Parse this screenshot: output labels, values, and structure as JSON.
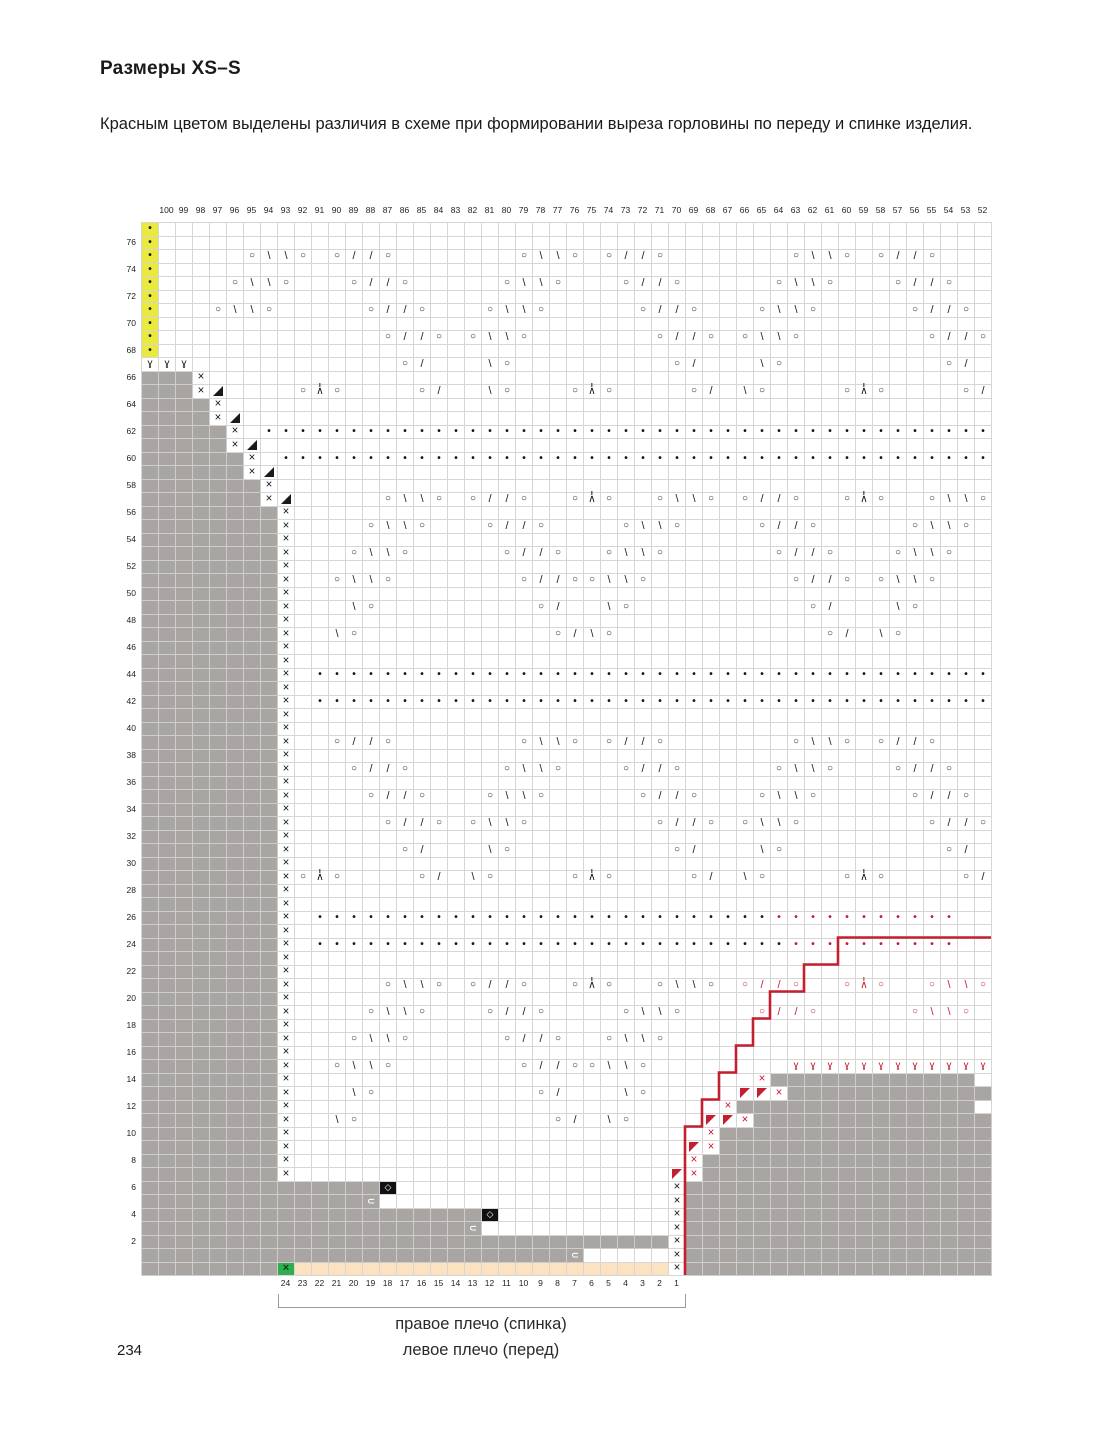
{
  "page": {
    "title": "Размеры XS–S",
    "description": "Красным цветом выделены различия в схеме при формировании выреза горловины по переду и спинке изделия.",
    "page_number": "234"
  },
  "chart_data": {
    "type": "knitting-chart",
    "title": "Схема вязания, размеры XS–S",
    "grid_size": {
      "columns": 50,
      "rows": 78
    },
    "columns_top": [
      100,
      99,
      98,
      97,
      96,
      95,
      94,
      93,
      92,
      91,
      90,
      89,
      88,
      87,
      86,
      85,
      84,
      83,
      82,
      81,
      80,
      79,
      78,
      77,
      76,
      75,
      74,
      73,
      72,
      71,
      70,
      69,
      68,
      67,
      66,
      65,
      64,
      63,
      62,
      61,
      60,
      59,
      58,
      57,
      56,
      55,
      54,
      53,
      52
    ],
    "rows_left": [
      76,
      74,
      72,
      70,
      68,
      66,
      64,
      62,
      60,
      58,
      56,
      54,
      52,
      50,
      48,
      46,
      44,
      42,
      40,
      38,
      36,
      34,
      32,
      30,
      28,
      26,
      24,
      22,
      20,
      18,
      16,
      14,
      12,
      10,
      8,
      6,
      4,
      2
    ],
    "columns_bottom": [
      24,
      23,
      22,
      21,
      20,
      19,
      18,
      17,
      16,
      15,
      14,
      13,
      12,
      11,
      10,
      9,
      8,
      7,
      6,
      5,
      4,
      3,
      2,
      1
    ],
    "bottom_numbers_start_column_index": 8,
    "colors": {
      "red": "#c41f30",
      "gray": "#a8a5a2",
      "yellow": "#e9e93e",
      "green": "#2fae4e",
      "beige": "#fbe3c2",
      "blackcell": "#111111",
      "gridline": "#d6d6d6"
    },
    "symbol_key": {
      ".": "empty",
      "g": "gray-no-stitch",
      "y": "yellow-edge-cell-purl-dot",
      "o": "yarn-over",
      "O": "yarn-over-red",
      "f": "left-slant-decrease",
      "F": "left-slant-decrease-red",
      "b": "right-slant-decrease",
      "B": "right-slant-decrease-red",
      "p": "purl-dot",
      "P": "purl-dot-red",
      "x": "cross-stitch",
      "X": "cross-stitch-red",
      "a": "central-double-decrease",
      "W": "central-double-decrease-red",
      "t": "bind-off-triangle-black",
      "T": "bind-off-triangle-red",
      "v": "twisted-stitch",
      "V": "twisted-stitch-red",
      "d": "black-cell-white-diamond",
      "c": "gray-cell-white-bracket",
      "e": "green-cell-cross",
      "n": "beige-highlight-cell"
    },
    "grid": [
      "y.................................................",
      "y.................................................",
      "y.....obbo.offo.......obbo.offo.......obbo.offo...",
      "y.................................................",
      "y....obbo...offo.....obbo...offo.....obbo...offo..",
      "y.................................................",
      "y...obbo.....offo...obbo.....offo...obbo.....offo.",
      "y.................................................",
      "y.............offo.obbo.......offo.obbo.......offo",
      "y.................................................",
      "vvv............of...bo.........of...bo.........of.",
      "gggx..............................................",
      "gggxt....oao....of..bo...oao....of.bo....oao....of",
      "ggggx.............................................",
      "ggggxt............................................",
      "gggggx.ppppppppppppppppppppppppppppppppppppppppppp",
      "gggggxt...........................................",
      "ggggggx.pppppppppppppppppppppppppppppppppppppppppp",
      "ggggggxt..........................................",
      "gggggggx..........................................",
      "gggggggxt.....obbo.offo..oao..obbo.offo..oao..obbo",
      "ggggggggx.........................................",
      "ggggggggx....obbo...offo....obbo....offo.....obbo.",
      "ggggggggx.........................................",
      "ggggggggx...obbo.....offo..obbo......offo...obbo..",
      "ggggggggx.........................................",
      "ggggggggx..obbo.......offoobbo........offo.obbo...",
      "ggggggggx.........................................",
      "ggggggggx...bo.........of..bo..........of...bo....",
      "ggggggggx.........................................",
      "ggggggggx..bo...........ofbo............of.bo.....",
      "ggggggggx.........................................",
      "ggggggggx.........................................",
      "ggggggggx.pppppppppppppppppppppppppppppppppppppppp",
      "ggggggggx.........................................",
      "ggggggggx.pppppppppppppppppppppppppppppppppppppppp",
      "ggggggggx.........................................",
      "ggggggggx.........................................",
      "ggggggggx..offo.......obbo.offo.......obbo.offo...",
      "ggggggggx.........................................",
      "ggggggggx...offo.....obbo...offo.....obbo...offo..",
      "ggggggggx.........................................",
      "ggggggggx....offo...obbo.....offo...obbo.....offo.",
      "ggggggggx.........................................",
      "ggggggggx.....offo.obbo.......offo.obbo.......offo",
      "ggggggggx.........................................",
      "ggggggggx......of...bo.........of...bo.........of.",
      "ggggggggx.........................................",
      "ggggggggxoao....of.bo....oao....of.bo....oao....of",
      "ggggggggx.........................................",
      "ggggggggx.........................................",
      "ggggggggx.pppppppppppppppppppppppppppPPPPPPPPPPP",
      "ggggggggx.........................................",
      "ggggggggx.ppppppppppppppppppppppppppppPPPPPPPPPP",
      "ggggggggx.........................................",
      "ggggggggx.........................................",
      "ggggggggx.....obbo.offo..oao..obbo.OFFO..OWO..OBBO",
      "ggggggggx.........................................",
      "ggggggggx....obbo...offo....obbo....OFFO.....OBBO.",
      "ggggggggx.........................................",
      "ggggggggx...obbo.....offo..obbo...................",
      "ggggggggx.........................................",
      "ggggggggx..obbo.......offoobbo........VVVVVVVVVVVV",
      "ggggggggx...........................Xgggggggggggg",
      "ggggggggx...bo.........of...bo.....TTXgggggggggggg",
      "ggggggggx.........................Xgggggggggggggg",
      "ggggggggx..bo...........of.bo....TTXgggggggggggggg",
      "ggggggggx........................Xgggggggggggggggg",
      "ggggggggx.......................TXgggggggggggggggg",
      "ggggggggx.......................Xggggggggggggggggg",
      "ggggggggx......................TXggggggggggggggggg",
      "ggggggggggggggd................xgggggggggggggggggg",
      "gggggggggggggc.................xgggggggggggggggggg",
      "ggggggggggggggggggggd..........xgggggggggggggggggg",
      "gggggggggggggggggggc...........xgggggggggggggggggg",
      "gggggggggggggggggggggggggggggggxgggggggggggggggggg",
      "gggggggggggggggggggggggggc.....xgggggggggggggggggg",
      "ggggggggennnnnnnnnnnnnnnnnnnnnnxgggggggggggggggggg"
    ],
    "neckline_polyline": [
      [
        50,
        53
      ],
      [
        41,
        53
      ],
      [
        41,
        55
      ],
      [
        39,
        55
      ],
      [
        39,
        57
      ],
      [
        37,
        57
      ],
      [
        37,
        59
      ],
      [
        36,
        59
      ],
      [
        36,
        61
      ],
      [
        35,
        61
      ],
      [
        35,
        63
      ],
      [
        34,
        63
      ],
      [
        34,
        65
      ],
      [
        33,
        65
      ],
      [
        33,
        67
      ],
      [
        32,
        67
      ],
      [
        32,
        78
      ]
    ],
    "footer": {
      "line1": "правое плечо (спинка)",
      "line2": "левое плечо (перед)"
    }
  }
}
